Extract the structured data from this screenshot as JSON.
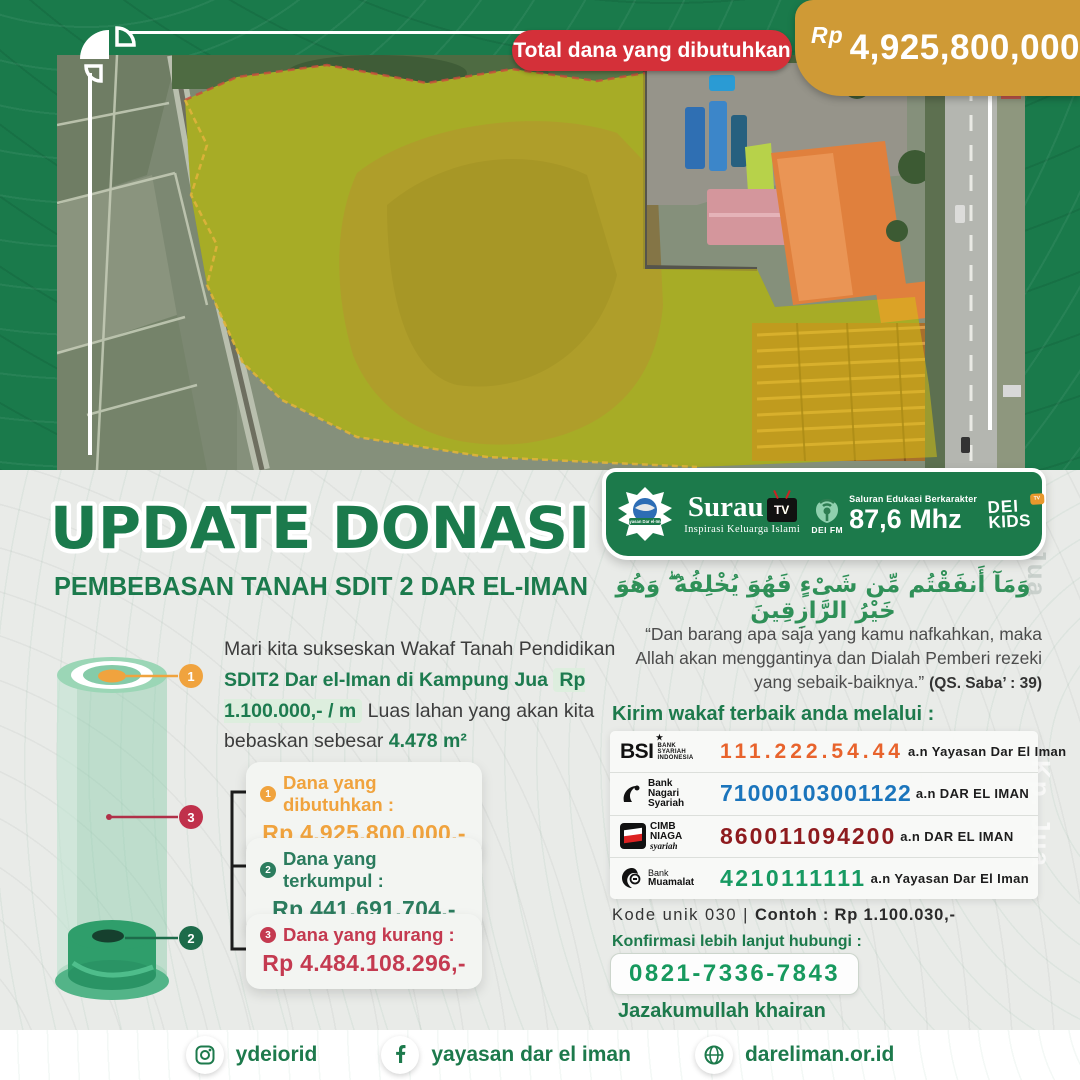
{
  "header": {
    "total_label": "Total dana yang dibutuhkan",
    "currency": "Rp",
    "amount": "4,925,800,000,-"
  },
  "title": {
    "main": "UPDATE DONASI",
    "sub": "PEMBEBASAN TANAH SDIT 2 DAR EL-IMAN"
  },
  "intro": {
    "part1": "Mari kita sukseskan Wakaf Tanah Pendidikan ",
    "bold1": "SDIT2",
    "sep1": "  ",
    "bold2": "Dar el-Iman di Kampung Jua",
    "sep2": " ",
    "price": "Rp 1.100.000,- / m",
    "part2": "  Luas lahan yang akan kita bebaskan sebesar ",
    "area": "4.478 m²"
  },
  "cylinder": {
    "marker_top": "1",
    "marker_middle": "3",
    "marker_bottom": "2"
  },
  "cards": [
    {
      "num": "1",
      "label": "Dana yang dibutuhkan :",
      "value": "Rp 4.925.800.000,-",
      "color": "#f0a33e"
    },
    {
      "num": "2",
      "label": "Dana yang terkumpul :",
      "value": "Rp 441.691.704,-",
      "color": "#2b7c5e"
    },
    {
      "num": "3",
      "label": "Dana yang kurang :",
      "value": "Rp 4.484.108.296,-",
      "color": "#c43a50"
    }
  ],
  "media": {
    "yayasan_name": "Yayasan Dar el-Iman",
    "surau_name": "Surau",
    "surau_tv": "TV",
    "surau_tagline": "Inspirasi Keluarga Islami",
    "deifm_label": "DEI FM",
    "deifm_tagline": "Saluran Edukasi Berkarakter",
    "deifm_freq": "87,6 Mhz",
    "deikids_line1": "DEI",
    "deikids_line2": "KIDS",
    "deikids_tv": "TV"
  },
  "verse": {
    "arabic": "وَمَآ أَنفَقْتُم مِّن شَىْءٍ فَهُوَ يُخْلِفُهُ ۖ وَهُوَ خَيْرُ الرَّازِقِينَ",
    "translation": "“Dan barang apa saja yang kamu nafkahkan, maka Allah akan menggantinya dan Dialah Pemberi rezeki yang sebaik-baiknya.” ",
    "reference": "(QS. Saba’ : 39)"
  },
  "donate": {
    "heading": "Kirim wakaf terbaik anda melalui :",
    "banks": [
      {
        "name": "BSI",
        "name_lines": [
          "BANK",
          "SYARIAH",
          "INDONESIA"
        ],
        "account": "111.222.54.44",
        "holder": "a.n Yayasan Dar El Iman",
        "color": "#e8632c"
      },
      {
        "name_lines": [
          "Bank",
          "Nagari",
          "Syariah"
        ],
        "account": "71000103001122",
        "holder": "a.n DAR EL IMAN",
        "color": "#1b75bc"
      },
      {
        "name_lines": [
          "CIMB",
          "NIAGA"
        ],
        "name_script": "syariah",
        "account": "860011094200",
        "holder": "a.n DAR EL IMAN",
        "color": "#8e1b1e"
      },
      {
        "name_lines": [
          "Bank",
          "Muamalat"
        ],
        "account": "4210111111",
        "holder": "a.n Yayasan Dar El Iman",
        "color": "#179a62"
      }
    ]
  },
  "unique_code": {
    "normal": "Kode unik 030 | ",
    "bold": "Contoh : Rp 1.100.030,-"
  },
  "contact": {
    "heading": "Konfirmasi lebih lanjut hubungi :",
    "phone": "0821-7336-7843",
    "closing": "Jazakumullah khairan"
  },
  "footer": {
    "instagram": "ydeiorid",
    "facebook": "yayasan dar el iman",
    "website": "dareliman.or.id"
  },
  "watermark": "Kp. Jua",
  "colors": {
    "primary_green": "#1b7a4c",
    "gold": "#cf9a36",
    "red_pill": "#d43039",
    "card_orange": "#f0a33e",
    "card_green": "#2b7c5e",
    "card_red": "#c43a50",
    "bank_bsi": "#e8632c",
    "bank_nagari": "#1b75bc",
    "bank_cimb": "#8e1b1e",
    "bank_muamalat": "#179a62"
  }
}
